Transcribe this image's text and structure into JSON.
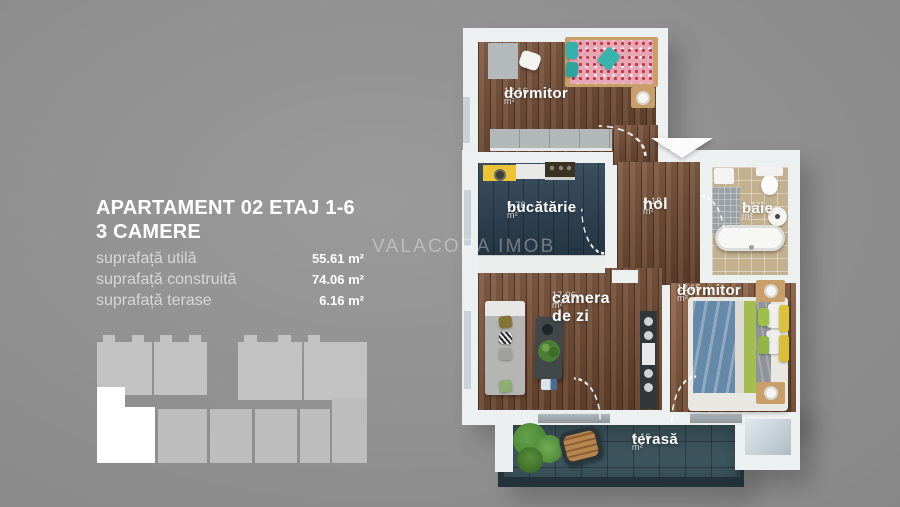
{
  "panel": {
    "title_line1": "APARTAMENT 02 ETAJ 1-6",
    "title_line2": "3 CAMERE",
    "areas": [
      {
        "label": "suprafață utilă",
        "value": "55.61 m²"
      },
      {
        "label": "suprafață construită",
        "value": "74.06 m²"
      },
      {
        "label": "suprafață terase",
        "value": "6.16 m²"
      }
    ]
  },
  "watermark": "VALACORA IMOB",
  "floorplan": {
    "rooms": [
      {
        "name": "dormitor",
        "area": "12.16 m²"
      },
      {
        "name": "bucătărie",
        "area": "5.78 m²"
      },
      {
        "name": "hol",
        "area": "4.18 m²"
      },
      {
        "name": "baie",
        "area": "3.77 m²"
      },
      {
        "name": "camera de zi",
        "area": "17.06 m²"
      },
      {
        "name": "dormitor",
        "area": "12.65 m²"
      },
      {
        "name": "terasă",
        "area": "6.16 m²"
      }
    ]
  },
  "colors": {
    "background": "#8b8b8b",
    "wall": "#edf0f1",
    "wood_floor": "#6d4730",
    "kitchen_floor": "#2d4254",
    "bath_tile": "#c3b08f",
    "terrace_tile": "#3e565f",
    "highlight_unit": "#ffffff"
  }
}
